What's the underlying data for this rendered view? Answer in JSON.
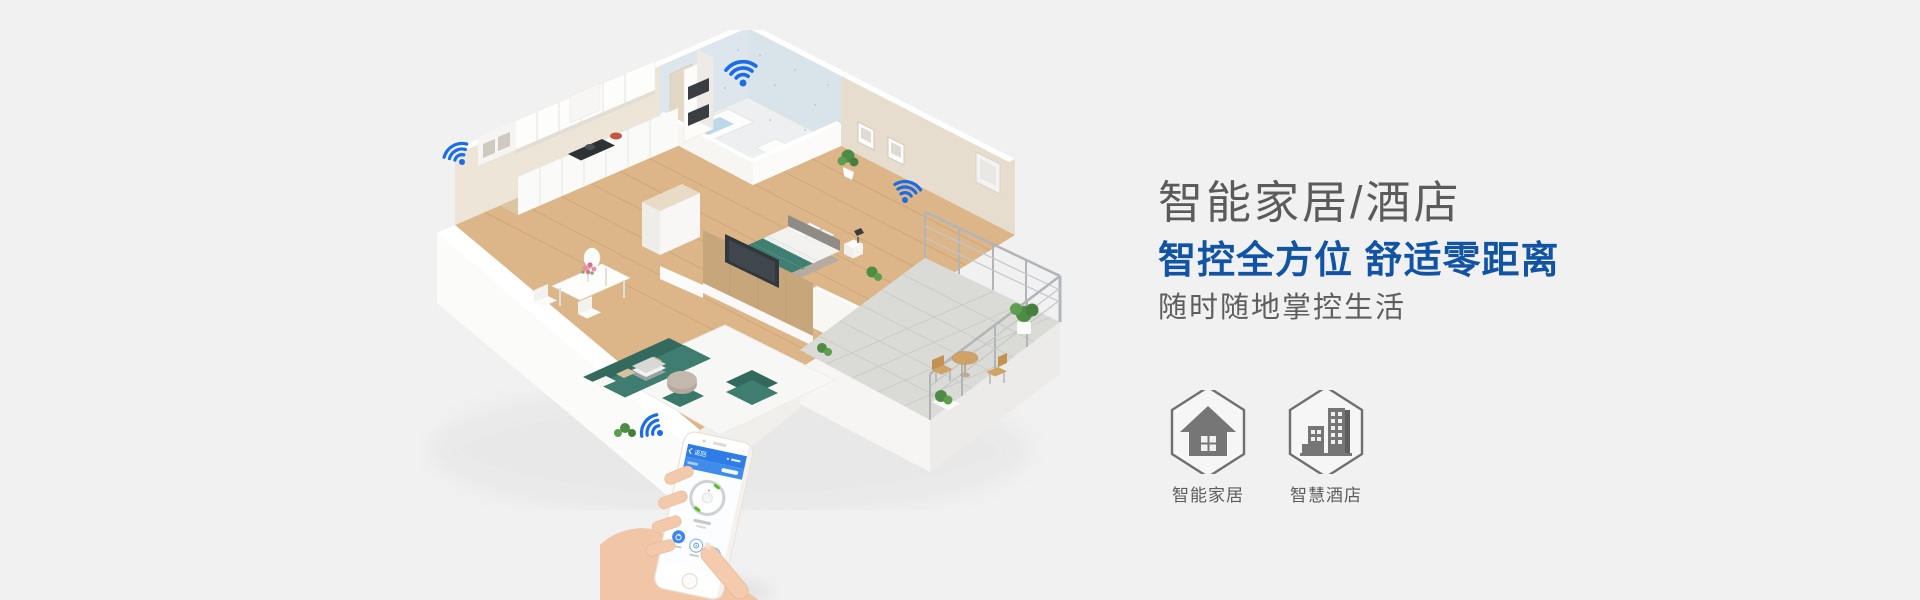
{
  "page": {
    "background": "#f1f1f2"
  },
  "hero": {
    "title": "智能家居/酒店",
    "subtitle": "智控全方位 舒适零距离",
    "tagline": "随时随地掌控生活",
    "title_color": "#5b5b5b",
    "subtitle_color": "#1254a4",
    "tagline_color": "#5f5d5d"
  },
  "badges": [
    {
      "label": "智能家居",
      "icon": "house-icon"
    },
    {
      "label": "智慧酒店",
      "icon": "buildings-icon"
    }
  ],
  "illustration": {
    "type": "isometric-smart-apartment",
    "wifi_color": "#1b6ce8",
    "wifi_hotspots": 4,
    "rooms": [
      "kitchen",
      "bathroom",
      "bedroom",
      "living-room",
      "dining-area",
      "balcony"
    ]
  },
  "phone": {
    "back_label": "返回"
  }
}
